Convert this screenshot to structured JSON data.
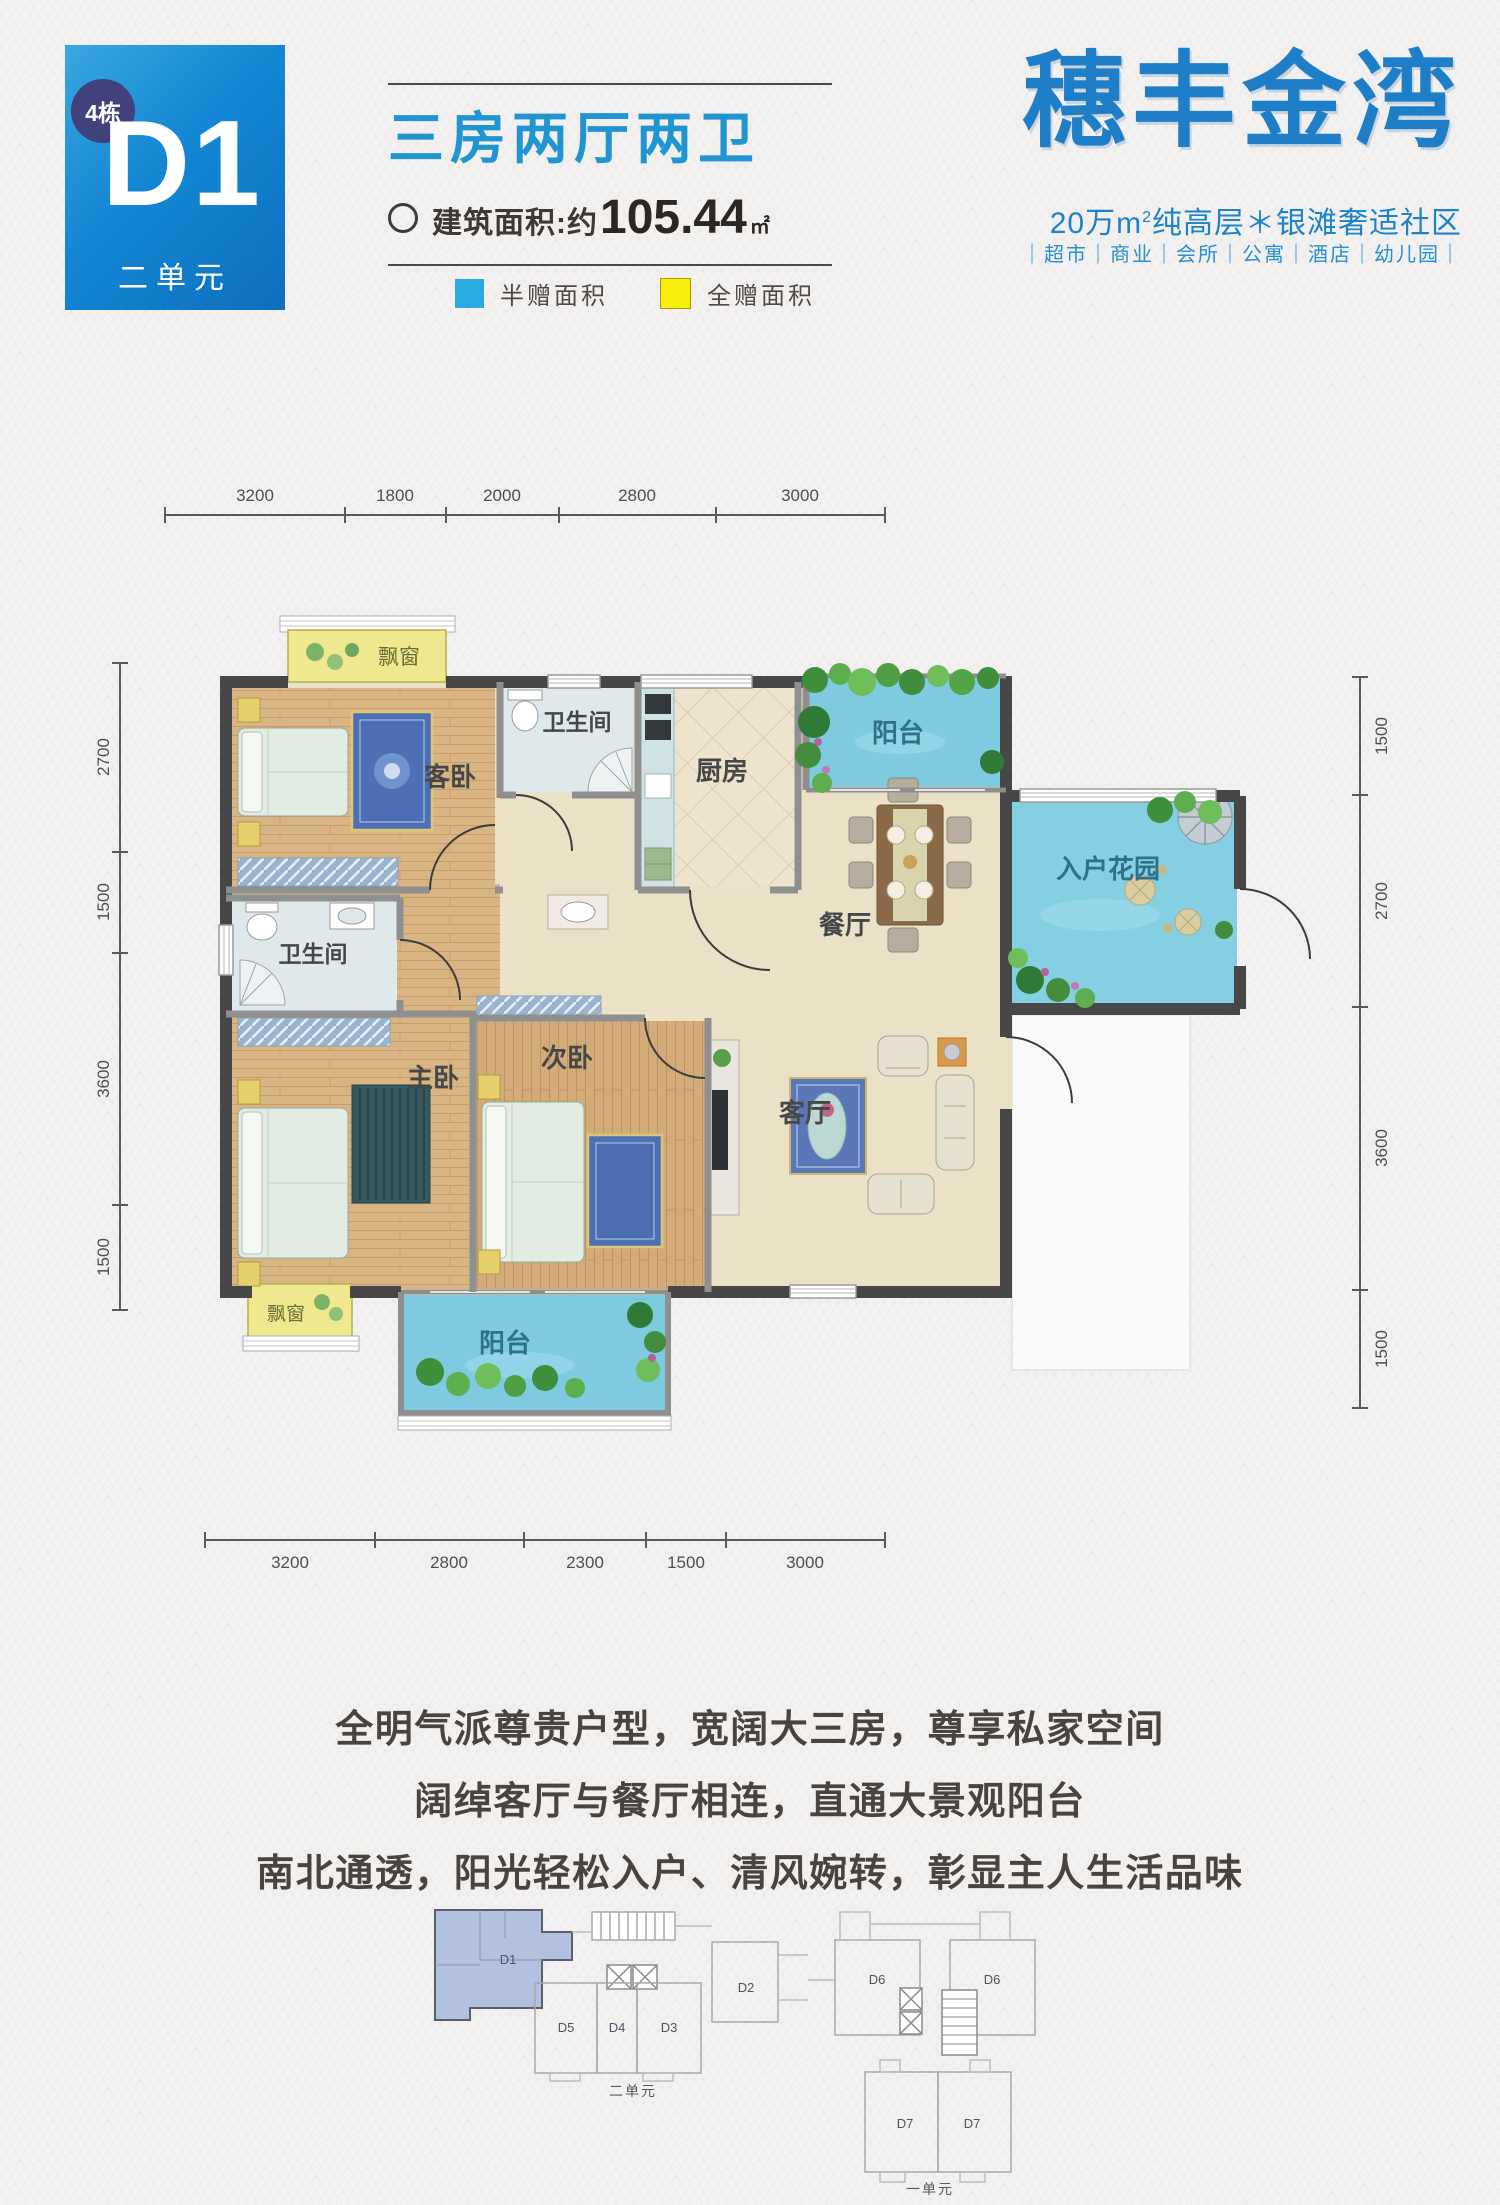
{
  "header": {
    "unit_badge": "4栋",
    "unit_code": "D1",
    "unit_name": "二单元",
    "title": "三房两厅两卫",
    "area_prefix": "建筑面积:约",
    "area_value": "105.44",
    "area_unit": "㎡",
    "legend_half": "半赠面积",
    "legend_full": "全赠面积",
    "logo": "穗丰金湾",
    "tagline_prefix": "20万m",
    "tagline_sup": "2",
    "tagline_suffix": "纯高层＊银滩奢适社区",
    "services": "｜超市｜商业｜会所｜公寓｜酒店｜幼儿园｜"
  },
  "colors": {
    "unit_box_blue": "#1487d4",
    "badge_purple": "#41417c",
    "title_blue": "#2095d2",
    "legend_half_blue": "#29abe2",
    "legend_full_yellow": "#f8ee0e",
    "logo_blue": "#1e7ec8",
    "water_blue": "#7ecadf",
    "wood_floor": "#dab584",
    "bay_yellow": "#efe88f",
    "keyplan_d1_fill": "#b3c1e0"
  },
  "plan": {
    "rooms": {
      "guest": "客卧",
      "bath": "卫生间",
      "kitchen": "厨房",
      "balcony": "阳台",
      "dining": "餐厅",
      "garden": "入户花园",
      "master": "主卧",
      "second": "次卧",
      "living": "客厅",
      "bay": "飘窗"
    },
    "dims_top": [
      "3200",
      "1800",
      "2000",
      "2800",
      "3000"
    ],
    "dims_bottom": [
      "3200",
      "2800",
      "2300",
      "1500",
      "3000"
    ],
    "dims_left": [
      "2700",
      "1500",
      "3600",
      "1500"
    ],
    "dims_right": [
      "1500",
      "2700",
      "3600",
      "1500"
    ]
  },
  "copy": {
    "line1": "全明气派尊贵户型，宽阔大三房，尊享私家空间",
    "line2": "阔绰客厅与餐厅相连，直通大景观阳台",
    "line3": "南北通透，阳光轻松入户、清风婉转，彰显主人生活品味"
  },
  "keyplan": {
    "left_units": [
      "D1",
      "D5",
      "D4",
      "D3",
      "D2"
    ],
    "right_units": [
      "D6",
      "D6",
      "D7",
      "D7"
    ],
    "left_caption": "二单元",
    "right_caption": "一单元"
  }
}
